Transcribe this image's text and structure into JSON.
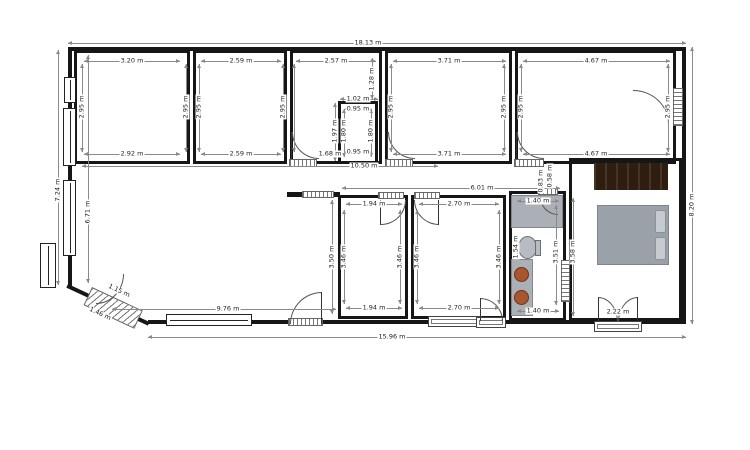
{
  "units": "m",
  "colors": {
    "wall": "#161616",
    "dimension": "#8a8a8a",
    "furniture_gray": "#aab0b6",
    "wardrobe_brown": "#2f1e10",
    "sink_copper": "#a7562f"
  },
  "dims": {
    "overall": {
      "top": "18.13 m",
      "bottom": "15.96 m",
      "left_outer": "7.24 m",
      "left_inner": "6.71 m",
      "right": "8.20 m",
      "diag_outer": "1.46 m",
      "diag_inner": "1.15 m"
    },
    "room1": {
      "top": "3.20 m",
      "bottom": "2.92 m",
      "left": "2.95 m",
      "right": "2.95 m"
    },
    "room2": {
      "top": "2.59 m",
      "bottom": "2.59 m",
      "left": "2.95 m",
      "right": "2.95 m"
    },
    "room3": {
      "top": "2.57 m",
      "door": "1.68 m",
      "above_closet": "1.28 m"
    },
    "closet": {
      "top_outer": "1.02 m",
      "top_inner": "0.95 m",
      "left_outer": "1.97 m",
      "left_inner": "1.80 m",
      "right": "1.80 m",
      "bottom": "0.95 m"
    },
    "room4": {
      "top": "3.71 m",
      "bottom": "3.71 m",
      "left": "2.95 m",
      "right": "2.95 m"
    },
    "room5": {
      "top": "4.67 m",
      "bottom": "4.67 m",
      "left": "2.95 m",
      "right": "2.95 m"
    },
    "living": {
      "width": "10.50 m",
      "bottom": "9.76 m"
    },
    "hallway": {
      "length": "6.01 m",
      "door_a": "0.83 m",
      "door_b": "0.58 m"
    },
    "room6": {
      "top": "1.94 m",
      "bottom": "1.94 m",
      "left_outer": "3.50 m",
      "left_inner": "3.46 m",
      "right": "3.46 m"
    },
    "room7": {
      "top": "2.70 m",
      "bottom": "2.70 m",
      "left": "3.46 m",
      "right": "3.46 m"
    },
    "bathroom": {
      "top": "1.40 m",
      "bottom": "1.40 m",
      "left": "1.54 m",
      "right": "3.51 m"
    },
    "bedroom": {
      "left": "3.58 m",
      "door": "2.22 m"
    }
  }
}
